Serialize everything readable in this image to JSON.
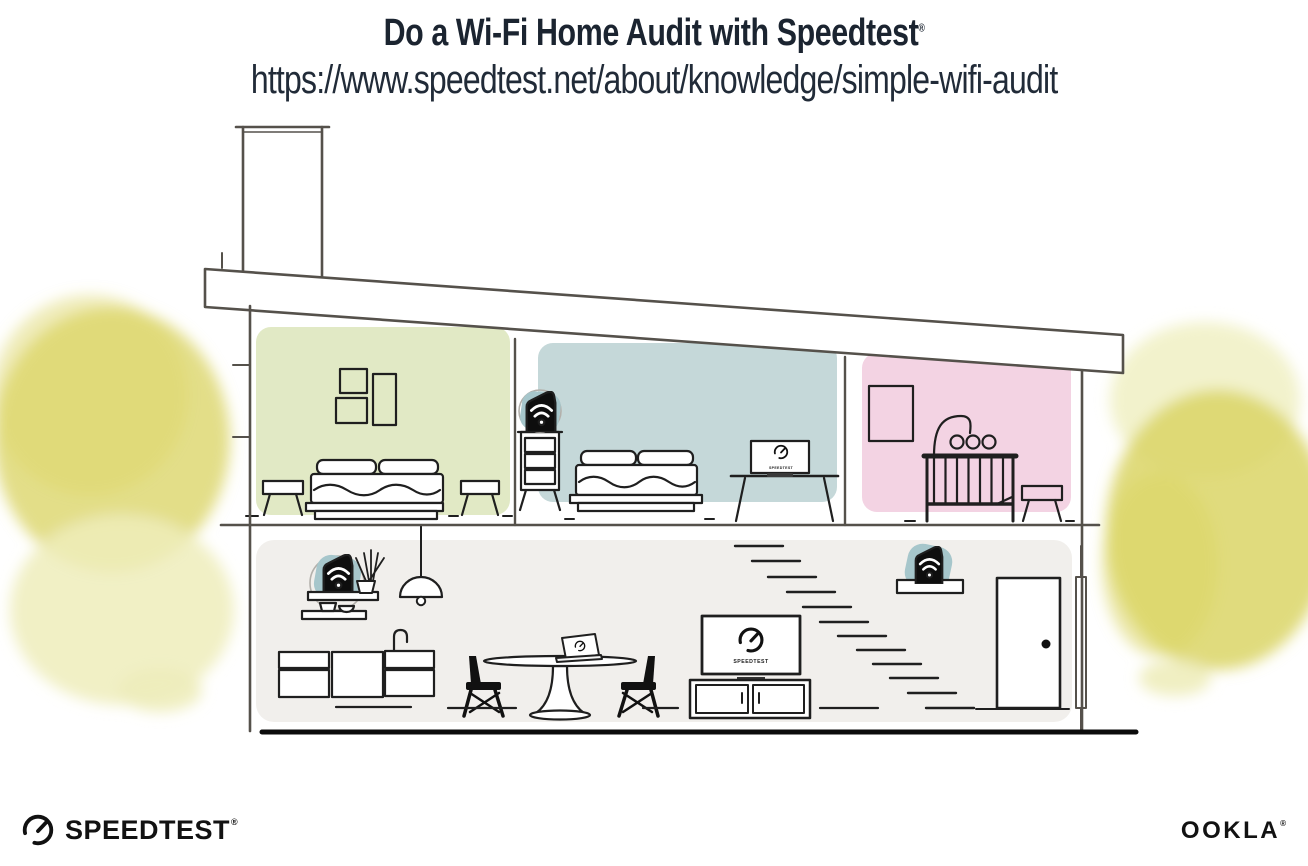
{
  "header": {
    "title": "Do a Wi-Fi Home Audit with Speedtest",
    "title_reg": "®",
    "url": "https://www.speedtest.net/about/knowledge/simple-wifi-audit"
  },
  "screens": {
    "tv_label": "SPEEDTEST",
    "bedroom_laptop_label": "SPEEDTEST"
  },
  "footer": {
    "speedtest_label": "SPEEDTEST",
    "speedtest_reg": "®",
    "ookla_label": "OOKLA",
    "ookla_reg": "®"
  },
  "icons": {
    "gauge": "speedtest-gauge-icon",
    "wifi": "wifi-signal-icon",
    "doorknob": "doorknob-dot"
  },
  "colors": {
    "ink": "#1b2430",
    "url-ink": "#212b38",
    "furn": "#1f1f1f",
    "wall": "#55514b",
    "room-green": "#e1e9c5",
    "room-teal": "#c5d8d9",
    "room-pink": "#f3d3e3",
    "room-lower": "#f1efec",
    "accent-teal": "#a6c6cb",
    "foliage": "#dbd566",
    "foliage-light": "#eeedbb"
  }
}
